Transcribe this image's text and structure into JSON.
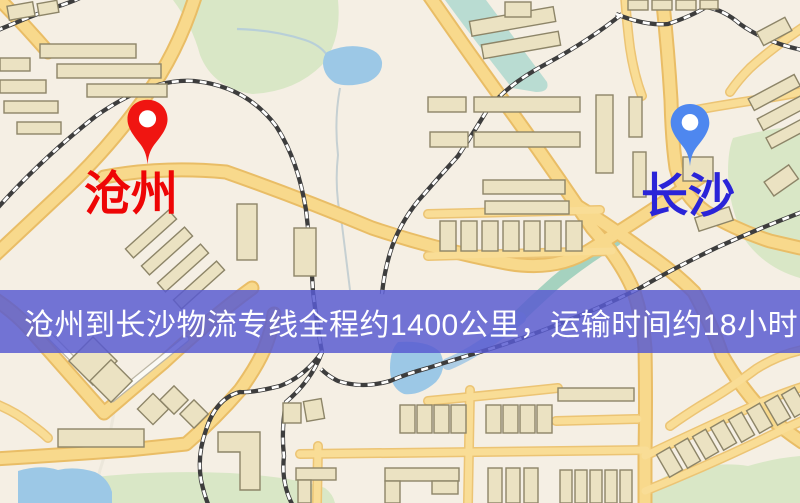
{
  "map": {
    "markers": [
      {
        "id": "origin",
        "label": "沧州",
        "icon": "location-pin-icon",
        "pin_color": "#f01511",
        "label_color": "#ee0505"
      },
      {
        "id": "destination",
        "label": "长沙",
        "icon": "location-pin-icon",
        "pin_color": "#4e87ef",
        "label_color": "#2a24d8"
      }
    ],
    "banner": {
      "text": "沧州到长沙物流专线全程约1400公里，运输时间约18小时17分钟.",
      "bg_color": "rgba(88,90,208,0.84)",
      "text_color": "#ffffff"
    },
    "palette": {
      "background": "#f5efe4",
      "road_fill": "#f8d98c",
      "road_edge": "#e9bd66",
      "water": "#9cc8e6",
      "green_area": "#d9e7c6",
      "building_fill": "#ebe2c2",
      "building_outline": "#8d8568",
      "railway_dark": "#3d3d3d",
      "railway_light": "#ffffff"
    }
  }
}
